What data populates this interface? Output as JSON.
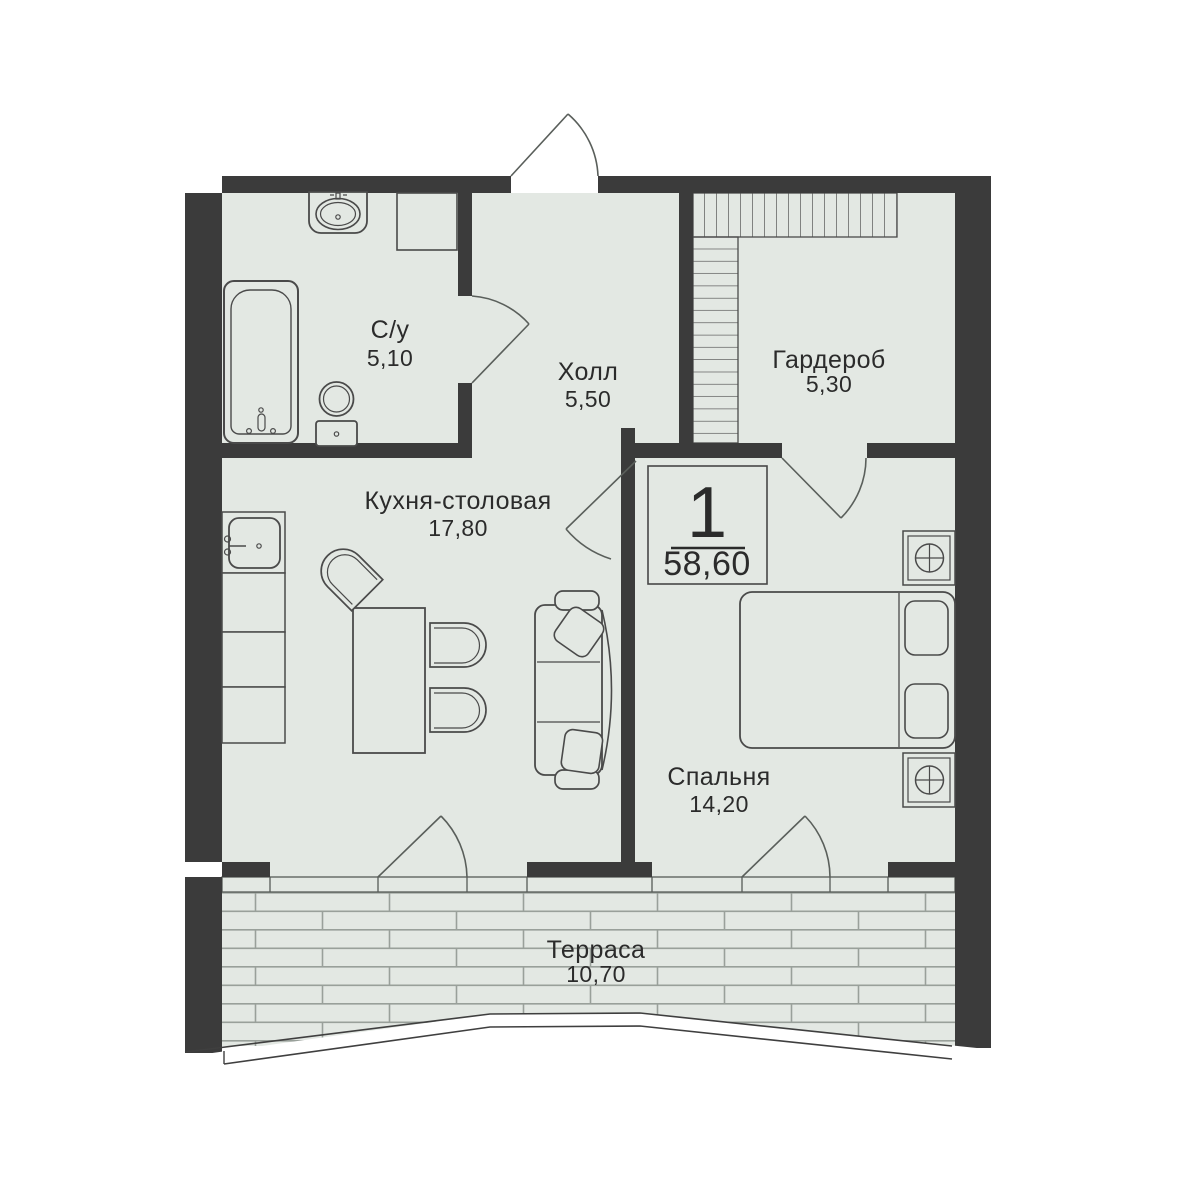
{
  "plan": {
    "unit_badge": {
      "rooms_count": "1",
      "total_area": "58,60"
    },
    "rooms": [
      {
        "id": "bathroom",
        "label": "С/у",
        "area": "5,10"
      },
      {
        "id": "hall",
        "label": "Холл",
        "area": "5,50"
      },
      {
        "id": "wardrobe",
        "label": "Гардероб",
        "area": "5,30"
      },
      {
        "id": "kitchen",
        "label": "Кухня-столовая",
        "area": "17,80"
      },
      {
        "id": "bedroom",
        "label": "Спальня",
        "area": "14,20"
      },
      {
        "id": "terrace",
        "label": "Терраса",
        "area": "10,70"
      }
    ],
    "colors": {
      "wall": "#3b3b3b",
      "floor": "#e3e8e3",
      "outline": "#4a4a4a",
      "door_arc": "#5a5f5b",
      "deck_line": "#99a09a",
      "text": "#2b2b2b",
      "background": "#ffffff"
    }
  }
}
